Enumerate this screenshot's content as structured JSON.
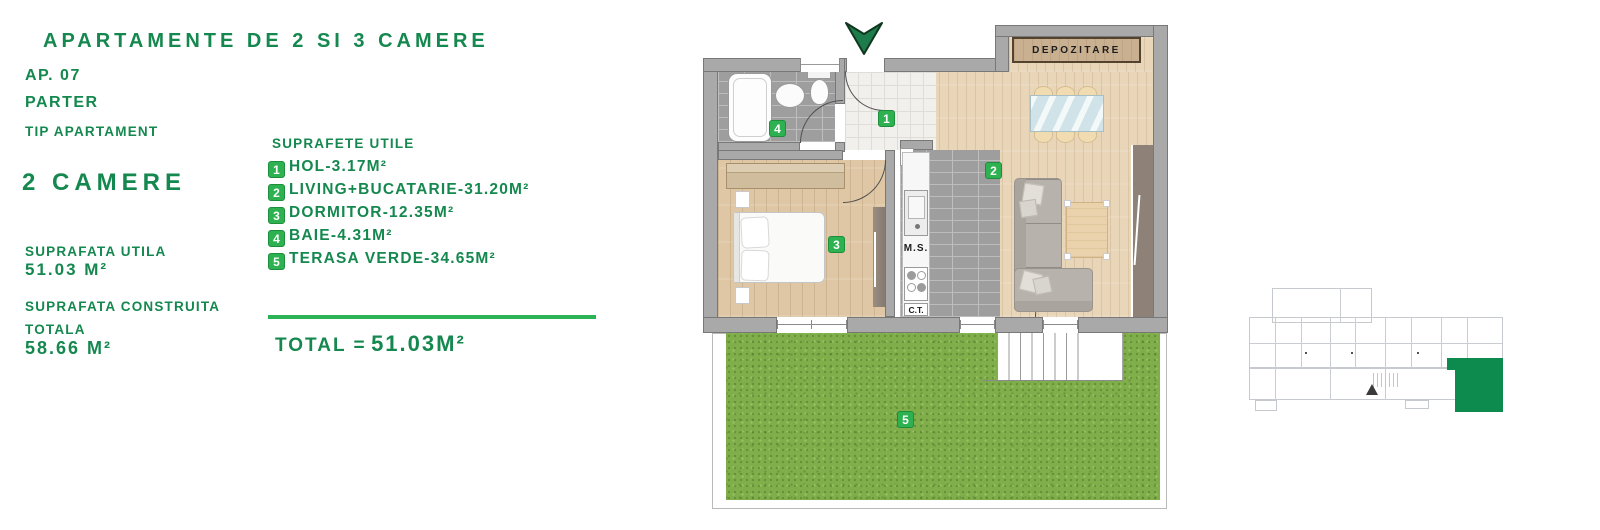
{
  "panel": {
    "title": "APARTAMENTE DE 2 SI 3 CAMERE",
    "ap_no": "AP. 07",
    "floor": "PARTER",
    "tip_label": "TIP APARTAMENT",
    "rooms": "2 CAMERE",
    "su_label": "SUPRAFATA UTILA",
    "su_value": "51.03 M²",
    "sc_label": "SUPRAFATA CONSTRUITA",
    "sc_label2": "TOTALA",
    "sc_value": "58.66 M²"
  },
  "legend": {
    "heading": "SUPRAFETE UTILE",
    "items": [
      {
        "num": "1",
        "label": "HOL-3.17M²"
      },
      {
        "num": "2",
        "label": "LIVING+BUCATARIE-31.20M²"
      },
      {
        "num": "3",
        "label": "DORMITOR-12.35M²"
      },
      {
        "num": "4",
        "label": "BAIE-4.31M²"
      },
      {
        "num": "5",
        "label": "TERASA VERDE-34.65M²"
      }
    ],
    "total_label": "TOTAL =",
    "total_value": "51.03M²"
  },
  "plan": {
    "storage_label": "DEPOZITARE",
    "ms_label": "M.S.",
    "ct_label": "C.T.",
    "markers": {
      "m1": "1",
      "m2": "2",
      "m3": "3",
      "m4": "4",
      "m5": "5"
    }
  },
  "colors": {
    "text_green": "#15884f",
    "badge_green": "#2eb150",
    "highlight_green": "#0d8a4e",
    "wall_gray": "#a9a9a9",
    "lawn_green": "#7fae4a"
  }
}
